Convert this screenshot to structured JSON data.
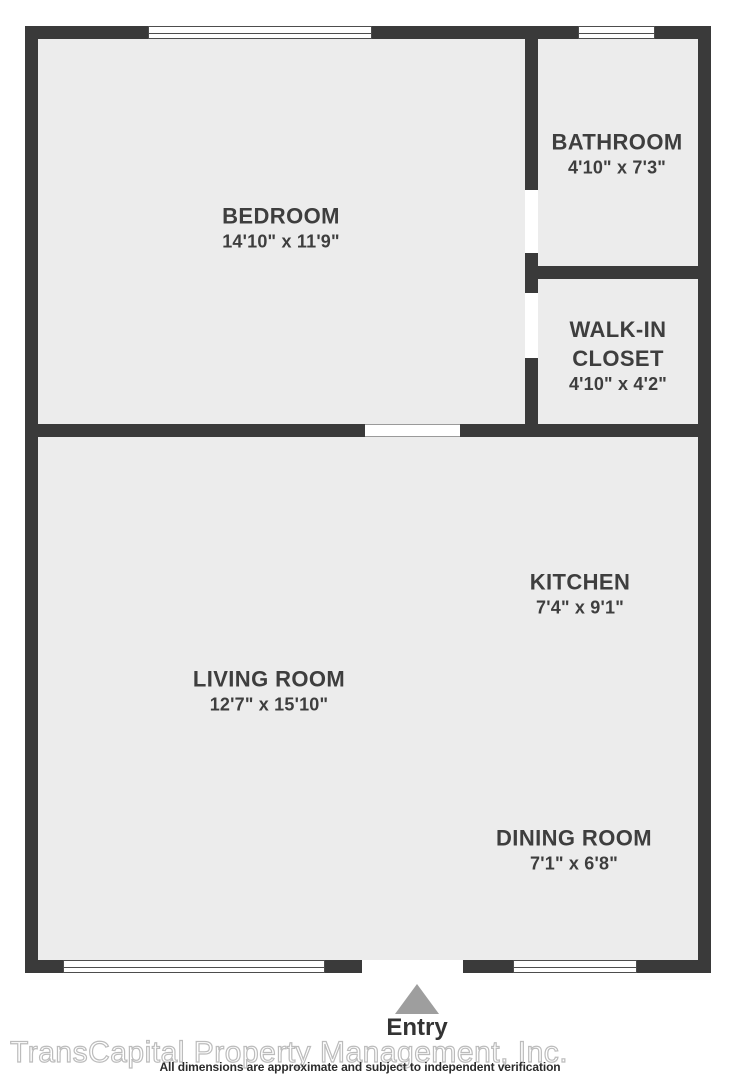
{
  "plan": {
    "rooms": [
      {
        "name": "BEDROOM",
        "dims": "14'10\" x 11'9\""
      },
      {
        "name": "BATHROOM",
        "dims": "4'10\" x 7'3\""
      },
      {
        "name": "WALK-IN CLOSET",
        "dims": "4'10\" x 4'2\""
      },
      {
        "name": "KITCHEN",
        "dims": "7'4\" x 9'1\""
      },
      {
        "name": "LIVING ROOM",
        "dims": "12'7\" x 15'10\""
      },
      {
        "name": "DINING ROOM",
        "dims": "7'1\" x 6'8\""
      }
    ],
    "entry_label": "Entry"
  },
  "footer": {
    "watermark": "TransCapital Property Management, Inc.",
    "disclaimer": "All dimensions are approximate and subject to independent verification"
  },
  "colors": {
    "wall": "#3a3a3a",
    "room_fill": "#ececec",
    "label_text": "#3e3e3e",
    "entry_arrow": "#9e9e9e",
    "watermark": "#bcbcbc"
  }
}
